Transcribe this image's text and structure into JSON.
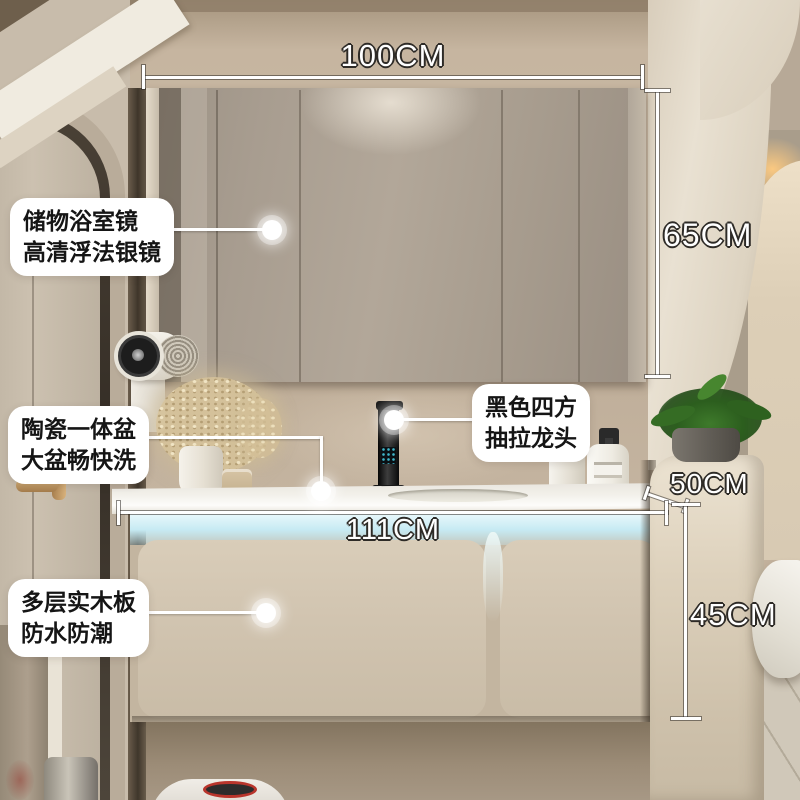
{
  "product_annotations": {
    "dimensions": {
      "top_width": "100CM",
      "mirror_height": "65CM",
      "counter_depth": "50CM",
      "cabinet_width": "111CM",
      "cabinet_height": "45CM"
    },
    "callouts": {
      "mirror": {
        "line1": "储物浴室镜",
        "line2": "高清浮法银镜"
      },
      "basin": {
        "line1": "陶瓷一体盆",
        "line2": "大盆畅快洗"
      },
      "faucet": {
        "line1": "黑色四方",
        "line2": "抽拉龙头"
      },
      "board": {
        "line1": "多层实木板",
        "line2": "防水防潮"
      }
    },
    "colors": {
      "annotation_text": "#ffffff",
      "annotation_outline": "#2e2b27",
      "callout_bg": "#ffffff",
      "callout_text": "#151515",
      "led_strip": "#cdedf5"
    }
  }
}
